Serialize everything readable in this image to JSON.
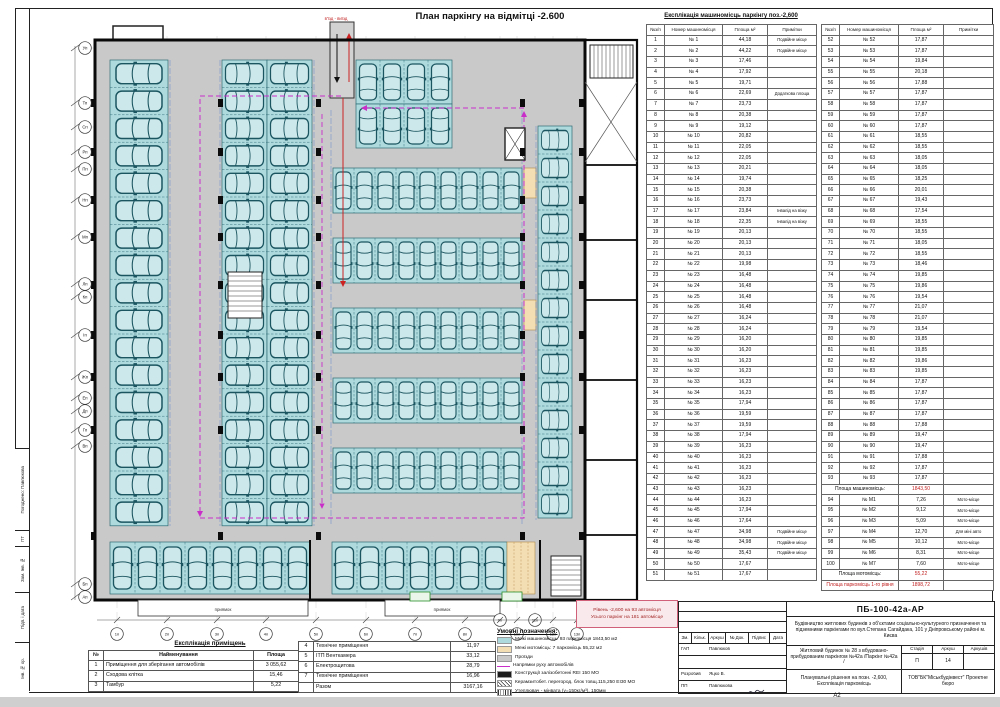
{
  "title": "План паркінгу на відмітці -2.600",
  "ramp_label": "в'їзд - виїзд",
  "pit_label": "приямок",
  "level_box": {
    "line1": "Рівень -2,600  на  93 автомісця",
    "line2": "Усього паркінг на 181 автомісце"
  },
  "axes": {
    "left": [
      "Уп",
      "Тп",
      "Сп",
      "Рп",
      "Пп",
      "Нп",
      "Мп",
      "Лп",
      "Кп",
      "Іп",
      "Жп",
      "Еп",
      "Дп",
      "Гп",
      "Вп",
      "Бп",
      "Ап"
    ],
    "bottom": [
      "1п",
      "2п",
      "3п",
      "4п",
      "5п",
      "6п",
      "7п",
      "8п",
      "9п",
      "10п",
      "11п",
      "12п",
      "13п"
    ]
  },
  "parking_table": {
    "title": "Експлікація машиномісць паркінгу поз.-2,600",
    "headers": [
      "№з/п",
      "Номер машиномісця",
      "Площа м²",
      "Примітки"
    ],
    "part1_rows": [
      [
        "1",
        "№ 1",
        "44,18",
        "Подвійне місце"
      ],
      [
        "2",
        "№ 2",
        "44,22",
        "Подвійне місце"
      ],
      [
        "3",
        "№ 3",
        "17,46",
        ""
      ],
      [
        "4",
        "№ 4",
        "17,92",
        ""
      ],
      [
        "5",
        "№ 5",
        "19,71",
        ""
      ],
      [
        "6",
        "№ 6",
        "22,69",
        "Додаткова площа"
      ],
      [
        "7",
        "№ 7",
        "23,73",
        ""
      ],
      [
        "8",
        "№ 8",
        "20,38",
        ""
      ],
      [
        "9",
        "№ 9",
        "19,12",
        ""
      ],
      [
        "10",
        "№ 10",
        "20,82",
        ""
      ],
      [
        "11",
        "№ 11",
        "22,05",
        ""
      ],
      [
        "12",
        "№ 12",
        "22,05",
        ""
      ],
      [
        "13",
        "№ 13",
        "20,21",
        ""
      ],
      [
        "14",
        "№ 14",
        "19,74",
        ""
      ],
      [
        "15",
        "№ 15",
        "20,38",
        ""
      ],
      [
        "16",
        "№ 16",
        "23,73",
        ""
      ],
      [
        "17",
        "№ 17",
        "23,84",
        "Інвалід на візку"
      ],
      [
        "18",
        "№ 18",
        "22,35",
        "Інвалід на візку"
      ],
      [
        "19",
        "№ 19",
        "20,13",
        ""
      ],
      [
        "20",
        "№ 20",
        "20,13",
        ""
      ],
      [
        "21",
        "№ 21",
        "20,13",
        ""
      ],
      [
        "22",
        "№ 22",
        "19,98",
        ""
      ],
      [
        "23",
        "№ 23",
        "16,48",
        ""
      ],
      [
        "24",
        "№ 24",
        "16,48",
        ""
      ],
      [
        "25",
        "№ 25",
        "16,48",
        ""
      ],
      [
        "26",
        "№ 26",
        "16,48",
        ""
      ],
      [
        "27",
        "№ 27",
        "16,24",
        ""
      ],
      [
        "28",
        "№ 28",
        "16,24",
        ""
      ],
      [
        "29",
        "№ 29",
        "16,20",
        ""
      ],
      [
        "30",
        "№ 30",
        "16,20",
        ""
      ],
      [
        "31",
        "№ 31",
        "16,23",
        ""
      ],
      [
        "32",
        "№ 32",
        "16,23",
        ""
      ],
      [
        "33",
        "№ 33",
        "16,23",
        ""
      ],
      [
        "34",
        "№ 34",
        "16,23",
        ""
      ],
      [
        "35",
        "№ 35",
        "17,94",
        ""
      ],
      [
        "36",
        "№ 36",
        "19,59",
        ""
      ],
      [
        "37",
        "№ 37",
        "19,59",
        ""
      ],
      [
        "38",
        "№ 38",
        "17,94",
        ""
      ],
      [
        "39",
        "№ 39",
        "16,23",
        ""
      ],
      [
        "40",
        "№ 40",
        "16,23",
        ""
      ],
      [
        "41",
        "№ 41",
        "16,23",
        ""
      ],
      [
        "42",
        "№ 42",
        "16,23",
        ""
      ],
      [
        "43",
        "№ 43",
        "16,23",
        ""
      ],
      [
        "44",
        "№ 44",
        "16,23",
        ""
      ],
      [
        "45",
        "№ 45",
        "17,94",
        ""
      ],
      [
        "46",
        "№ 46",
        "17,64",
        ""
      ],
      [
        "47",
        "№ 47",
        "34,98",
        "Подвійне місце"
      ],
      [
        "48",
        "№ 48",
        "34,98",
        "Подвійне місце"
      ],
      [
        "49",
        "№ 49",
        "35,43",
        "Подвійне місце"
      ],
      [
        "50",
        "№ 50",
        "17,67",
        ""
      ],
      [
        "51",
        "№ 51",
        "17,67",
        ""
      ]
    ],
    "part2_rows": [
      [
        "52",
        "№ 52",
        "17,87",
        ""
      ],
      [
        "53",
        "№ 53",
        "17,87",
        ""
      ],
      [
        "54",
        "№ 54",
        "19,84",
        ""
      ],
      [
        "55",
        "№ 55",
        "20,18",
        ""
      ],
      [
        "56",
        "№ 56",
        "17,88",
        ""
      ],
      [
        "57",
        "№ 57",
        "17,87",
        ""
      ],
      [
        "58",
        "№ 58",
        "17,87",
        ""
      ],
      [
        "59",
        "№ 59",
        "17,87",
        ""
      ],
      [
        "60",
        "№ 60",
        "17,87",
        ""
      ],
      [
        "61",
        "№ 61",
        "18,55",
        ""
      ],
      [
        "62",
        "№ 62",
        "18,55",
        ""
      ],
      [
        "63",
        "№ 63",
        "18,05",
        ""
      ],
      [
        "64",
        "№ 64",
        "18,05",
        ""
      ],
      [
        "65",
        "№ 65",
        "18,25",
        ""
      ],
      [
        "66",
        "№ 66",
        "20,01",
        ""
      ],
      [
        "67",
        "№ 67",
        "19,43",
        ""
      ],
      [
        "68",
        "№ 68",
        "17,54",
        ""
      ],
      [
        "69",
        "№ 69",
        "18,55",
        ""
      ],
      [
        "70",
        "№ 70",
        "18,55",
        ""
      ],
      [
        "71",
        "№ 71",
        "18,05",
        ""
      ],
      [
        "72",
        "№ 72",
        "18,55",
        ""
      ],
      [
        "73",
        "№ 73",
        "18,46",
        ""
      ],
      [
        "74",
        "№ 74",
        "19,85",
        ""
      ],
      [
        "75",
        "№ 75",
        "19,86",
        ""
      ],
      [
        "76",
        "№ 76",
        "19,54",
        ""
      ],
      [
        "77",
        "№ 77",
        "21,07",
        ""
      ],
      [
        "78",
        "№ 78",
        "21,07",
        ""
      ],
      [
        "79",
        "№ 79",
        "19,54",
        ""
      ],
      [
        "80",
        "№ 80",
        "19,85",
        ""
      ],
      [
        "81",
        "№ 81",
        "19,85",
        ""
      ],
      [
        "82",
        "№ 82",
        "19,86",
        ""
      ],
      [
        "83",
        "№ 83",
        "19,85",
        ""
      ],
      [
        "84",
        "№ 84",
        "17,87",
        ""
      ],
      [
        "85",
        "№ 85",
        "17,87",
        ""
      ],
      [
        "86",
        "№ 86",
        "17,87",
        ""
      ],
      [
        "87",
        "№ 87",
        "17,87",
        ""
      ],
      [
        "88",
        "№ 88",
        "17,88",
        ""
      ],
      [
        "89",
        "№ 89",
        "19,47",
        ""
      ],
      [
        "90",
        "№ 90",
        "19,47",
        ""
      ],
      [
        "91",
        "№ 91",
        "17,88",
        ""
      ],
      [
        "92",
        "№ 92",
        "17,87",
        ""
      ],
      [
        "93",
        "№ 93",
        "17,87",
        ""
      ]
    ],
    "moto_rows": [
      [
        "94",
        "№ М1",
        "7,26",
        "Мото-місце"
      ],
      [
        "95",
        "№ М2",
        "9,12",
        "Мото-місце"
      ],
      [
        "96",
        "№ М3",
        "5,09",
        "Мото-місце"
      ],
      [
        "97",
        "№ М4",
        "12,70",
        "Для міні авто"
      ],
      [
        "98",
        "№ М5",
        "10,12",
        "Мото-місце"
      ],
      [
        "99",
        "№ М6",
        "8,31",
        "Мото-місце"
      ],
      [
        "100",
        "№ М7",
        "7,60",
        "Мото-місце"
      ]
    ],
    "totals": {
      "mash_label": "Площа машиномісць:",
      "mash_value": "1843,50",
      "moto_label": "Площа мотомісць:",
      "moto_value": "55,22",
      "level_label": "Площа паркомісць 1-го рівня",
      "level_value": "1898,72"
    }
  },
  "rooms_table": {
    "title": "Експлікація приміщень",
    "headers": [
      "№",
      "Найменування",
      "Площа"
    ],
    "part1": [
      [
        "1",
        "Приміщення для зберігання автомобілів",
        "3 055,62"
      ],
      [
        "2",
        "Сходова клітка",
        "15,46"
      ],
      [
        "3",
        "Тамбур",
        "5,22"
      ]
    ],
    "part2": [
      [
        "4",
        "Технічне приміщення",
        "11,97"
      ],
      [
        "5",
        "ІТП Венткамера",
        "33,12"
      ],
      [
        "6",
        "Електрощитова",
        "28,79"
      ],
      [
        "7",
        "Технічне приміщення",
        "16,96"
      ]
    ],
    "total_label": "Разом",
    "total_value": "3167,16"
  },
  "legend": {
    "title": "Умовні позначення:",
    "items": [
      {
        "swatch": "stall",
        "text": "Межі машиномісць: 93 паркомісця  1843,50 м2"
      },
      {
        "swatch": "moto",
        "text": "Межі мотомісць: 7 паркомісць  55,22 м2"
      },
      {
        "swatch": "aisle",
        "text": "Проїзди"
      },
      {
        "swatch": "arrow",
        "text": "Напрямки руху автомобілів"
      },
      {
        "swatch": "concrete",
        "text": "Конструкції залізобетонні REI 150 МО"
      },
      {
        "swatch": "block",
        "text": "Керамзитобет. перегород. блок товщ.115,250  ЕІ30 МО"
      },
      {
        "swatch": "insul",
        "text": "Утеплювач - мінвата (γ=150кг/м³), 150мм"
      }
    ]
  },
  "title_block": {
    "code": "ПБ-100-42а-АР",
    "project": "Будівництво житлових будинків з об'єктами соціально-культурного призначення та підземними паркінгами по вул.Степана Сагайдака, 101 у Дніпровському районі м. Києва",
    "stamp_headers": [
      "Зм.",
      "Кільк.",
      "Аркуш",
      "№ Док.",
      "Підпис",
      "Дата"
    ],
    "roles": [
      {
        "role": "ГАП",
        "name": "Павлюков"
      },
      {
        "role": "Розробив",
        "name": "Яцко В."
      },
      {
        "role": "ПП",
        "name": "Павлюкова"
      }
    ],
    "object": "Житловий будинок № 28  з вбудовано-прибудованим паркінгом №42а /Паркінг №42а /",
    "stage_label": "Стадія",
    "stage": "П",
    "sheet_label": "Аркуш",
    "sheet": "14",
    "sheets_label": "Аркушів",
    "sheets": "",
    "content": "Планувальні рішення на позн. -2,600, Експлікація паркомісць",
    "org": "ТОВ\"БК\"Міськбудінвест\" Проектне бюро",
    "format": "А2"
  },
  "side_stamp": [
    "Погоджено: Павлюкова",
    "ПТ",
    "Зам. Інв. №",
    "Підп. і дата",
    "Інв. № ор."
  ]
}
